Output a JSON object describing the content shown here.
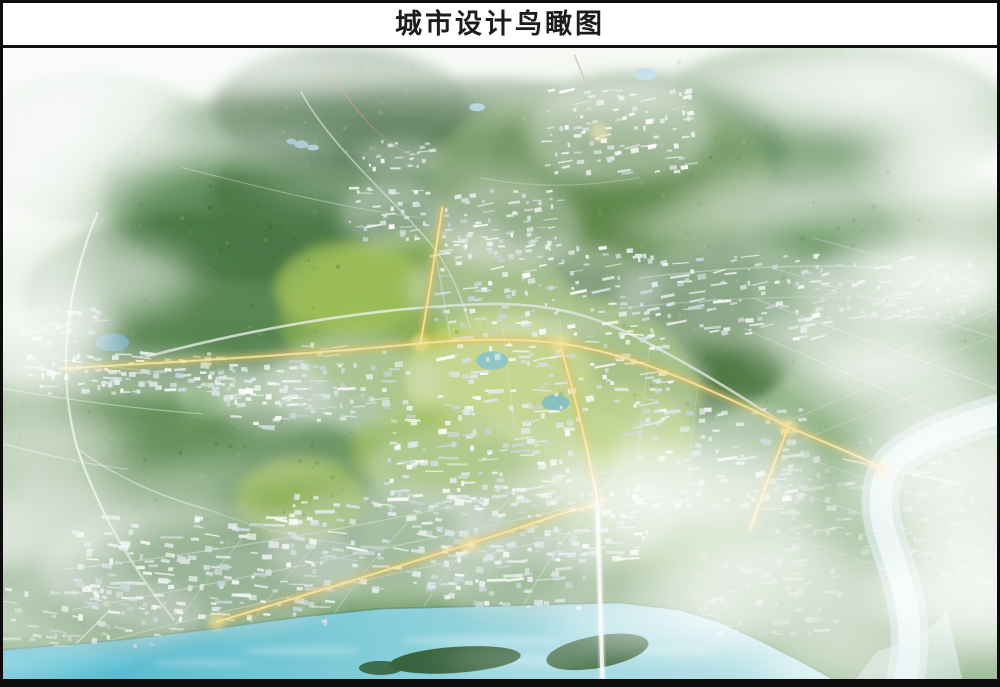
{
  "page": {
    "title": "城市设计鸟瞰图"
  },
  "frame": {
    "border_color": "#0d0d0d",
    "title_bg": "#ffffff",
    "title_text_color": "#1c1c1c"
  },
  "palette": {
    "haze_top": "#e9f0e6",
    "hill_light": "#c9dac2",
    "hill_mid": "#9abc8d",
    "hill_deep": "#7ba470",
    "hill_base": "#69975f",
    "forest_dark": "#31602c",
    "park_bright": "#b7cd50",
    "river_main": "#41b2ce",
    "river_light": "#c2e8ee",
    "river_tributary": "#cfe9ee",
    "road_gold": "#e8bb4e",
    "road_gold_core": "#f7e59a",
    "road_white": "#eef3ee",
    "building_white": "#ffffff",
    "cloud_white": "#ffffff"
  },
  "scene": {
    "features": [
      {
        "name": "forest-mountains",
        "color": "#31602c"
      },
      {
        "name": "central-parkland",
        "color": "#b7cd50"
      },
      {
        "name": "urban-fabric",
        "color": "#e8efec"
      },
      {
        "name": "satellite-town",
        "color": "#f1f5f3"
      },
      {
        "name": "main-river",
        "color": "#41b2ce"
      },
      {
        "name": "tributary-river",
        "color": "#cfe9ee"
      },
      {
        "name": "river-islands",
        "color": "#2e5b33"
      },
      {
        "name": "lit-arterial-roads",
        "color": "#e8bb4e"
      },
      {
        "name": "secondary-roads",
        "color": "#e2eae4"
      },
      {
        "name": "mountain-roads",
        "color": "#9a6a50"
      },
      {
        "name": "lakes",
        "color": "#3fa8b8"
      },
      {
        "name": "clouds-fog",
        "color": "#ffffff"
      }
    ]
  }
}
